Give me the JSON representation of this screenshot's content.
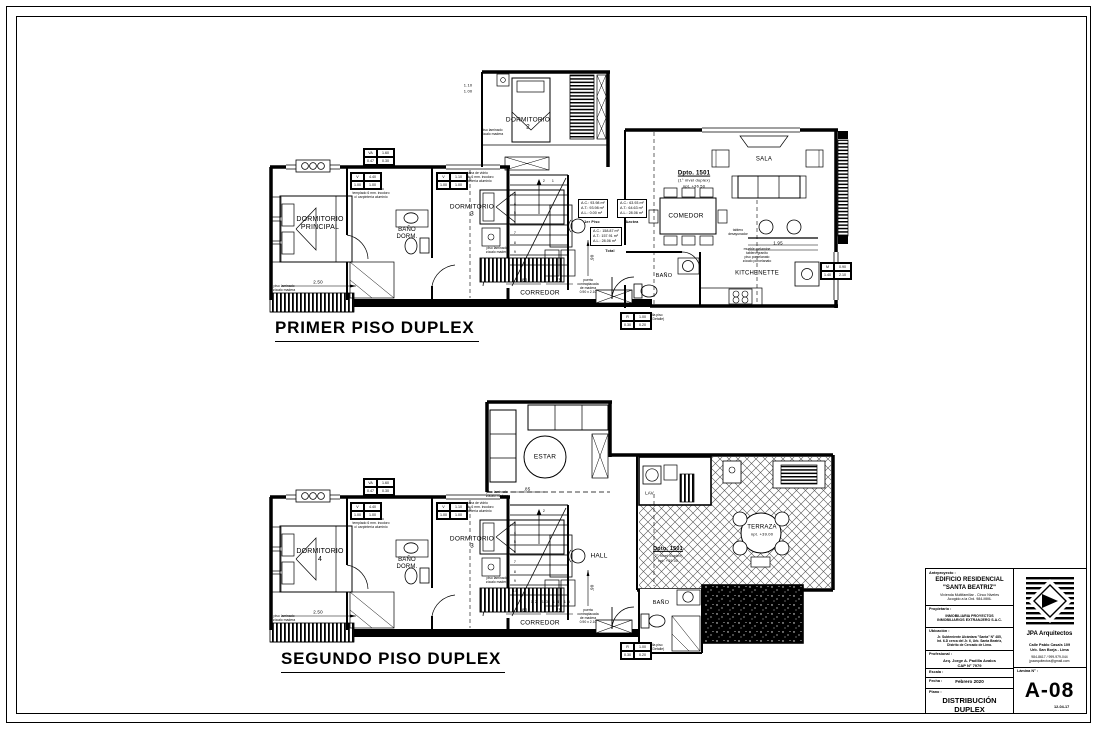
{
  "plan1": {
    "title": "PRIMER PISO DUPLEX",
    "unit_name": "Dpto. 1501",
    "unit_level": "(1° nivel duplex)",
    "unit_npt": "npt. +36.50",
    "rooms": {
      "principal": "DORMITORIO\nPRINCIPAL",
      "bano_dorm": "BAÑO\nDORM.",
      "dorm3": "DORMITORIO\n3",
      "dorm2": "DORMITORIO\n2",
      "corredor": "CORREDOR",
      "sala": "SALA",
      "comedor": "COMEDOR",
      "kitchenette": "KITCHENETTE",
      "bano": "BAÑO"
    },
    "areas": {
      "first": {
        "l1": "A.C.: 93.98 m²",
        "l2": "A.T.: 93.98 m²",
        "l3": "A.L.: 0.00 m²",
        "caption": "1er Piso"
      },
      "azotea": {
        "l1": "A.C.: 63.93 m²",
        "l2": "A.T.: 64.63 m²",
        "l3": "A.L.: 28.06 m²",
        "caption": "Azotea"
      },
      "total": {
        "l1": "A.C.: 158.87 m²",
        "l2": "A.T.: 157.91 m²",
        "l3": "A.L.: 28.06 m²",
        "caption": "Total"
      }
    },
    "stairs": {
      "top_a": "2",
      "top_b": "1",
      "column": "3\n4\n5\n6\n7\n8\n9"
    }
  },
  "plan2": {
    "title": "SEGUNDO PISO DUPLEX",
    "unit_name": "Dpto. 1501",
    "unit_level": "(2° nivel duplex)",
    "unit_npt": "npt. +39.00",
    "rooms": {
      "dorm4": "DORMITORIO\n4",
      "bano_dorm": "BAÑO\nDORM.",
      "dorm3": "DORMITORIO\n3",
      "estar": "ESTAR",
      "hall": "HALL",
      "corredor": "CORREDOR",
      "lav": "LAV.",
      "terraza": "TERRAZA",
      "terraza_npt": "npt. +39.00",
      "bano": "BAÑO"
    },
    "stairs": {
      "top_a": "2",
      "column": "3\n4\n5\n6\n7\n8\n9\n10",
      "bottom_row": "11 12 13 14 15"
    }
  },
  "notes": {
    "floor": "piso laminado\nzócalo madera",
    "window": "ventana de vidrio\ntemplado 6 mm. incoloro\nc/ carpintería aluminio",
    "door": "puerta\ncontraplacada\nde madera\n0.90 x 2.10",
    "counter": "mueble melamine\ntablero granito",
    "kitchen_floor": "piso porcelanato\nzócalo porcelanato",
    "bar": "tablero\ndesayunador",
    "grille": "rejilla piso\n(ver Detalle)"
  },
  "dims": {
    "w250": "2.50",
    "w80": ".80",
    "w75": ".75",
    "w195": "1.95",
    "w85": ".85",
    "h345": "3.45",
    "h90": ".90",
    "v110": "1.10",
    "v100": "1.00"
  },
  "tags": {
    "va": {
      "a": "VA",
      "b": "1.60",
      "c": "0.47",
      "d": "0.30"
    },
    "v1": {
      "a": "V",
      "b": "1.10",
      "c": "1.00",
      "d": "1.00"
    },
    "v2": {
      "a": "V",
      "b": "4.40",
      "c": "1.00",
      "d": "1.00"
    },
    "m": {
      "a": "M",
      "b": "0.90",
      "c": "1.40",
      "d": "2.10"
    },
    "r": {
      "a": "R",
      "b": "1.00",
      "c": "0.30",
      "d": "0.20"
    }
  },
  "titleblock": {
    "anteproyecto_label": "Anteproyecto :",
    "project_name": "EDIFICIO RESIDENCIAL\n\"SANTA BEATRIZ\"",
    "project_desc": "Vivienda Multifamiliar - Cinco Niveles\nAcogido a la Ord. 984-MML",
    "propietario_label": "Propietario :",
    "propietario_value": "INMOBILIARIA PROYECTOS\nINMOBILIARIOS EXTRANJERO S.A.C.",
    "ubicacion_label": "Ubicación :",
    "ubicacion_value": "Jr. Subteniente Alcántara \"Santa\" N° 485,\nInt. 6-D cerca del Jr. 6, Urb. Santa Beatriz,\nDistrito de Cercado de Lima.",
    "profesional_label": "Profesional :",
    "profesional_value": "Arq. Jorge A. Padilla Avalos\nCAP N° 7979",
    "escala_label": "Escala :",
    "fecha_label": "Fecha :",
    "fecha_value": "Febrero 2020",
    "plano_label": "Plano :",
    "plano_value": "DISTRIBUCIÓN\nDUPLEX",
    "firm_name": "JPA Arquitectos",
    "firm_address": "Calle Pablo Casals 109\nUrb. San Borja - Lima",
    "firm_phone": "984-8617 / 999-979-044\njpaarquitectos@gmail.com",
    "lamina_label": "Lámina N° :",
    "lamina_value": "A-08",
    "lamina_date": "12-04-17"
  }
}
